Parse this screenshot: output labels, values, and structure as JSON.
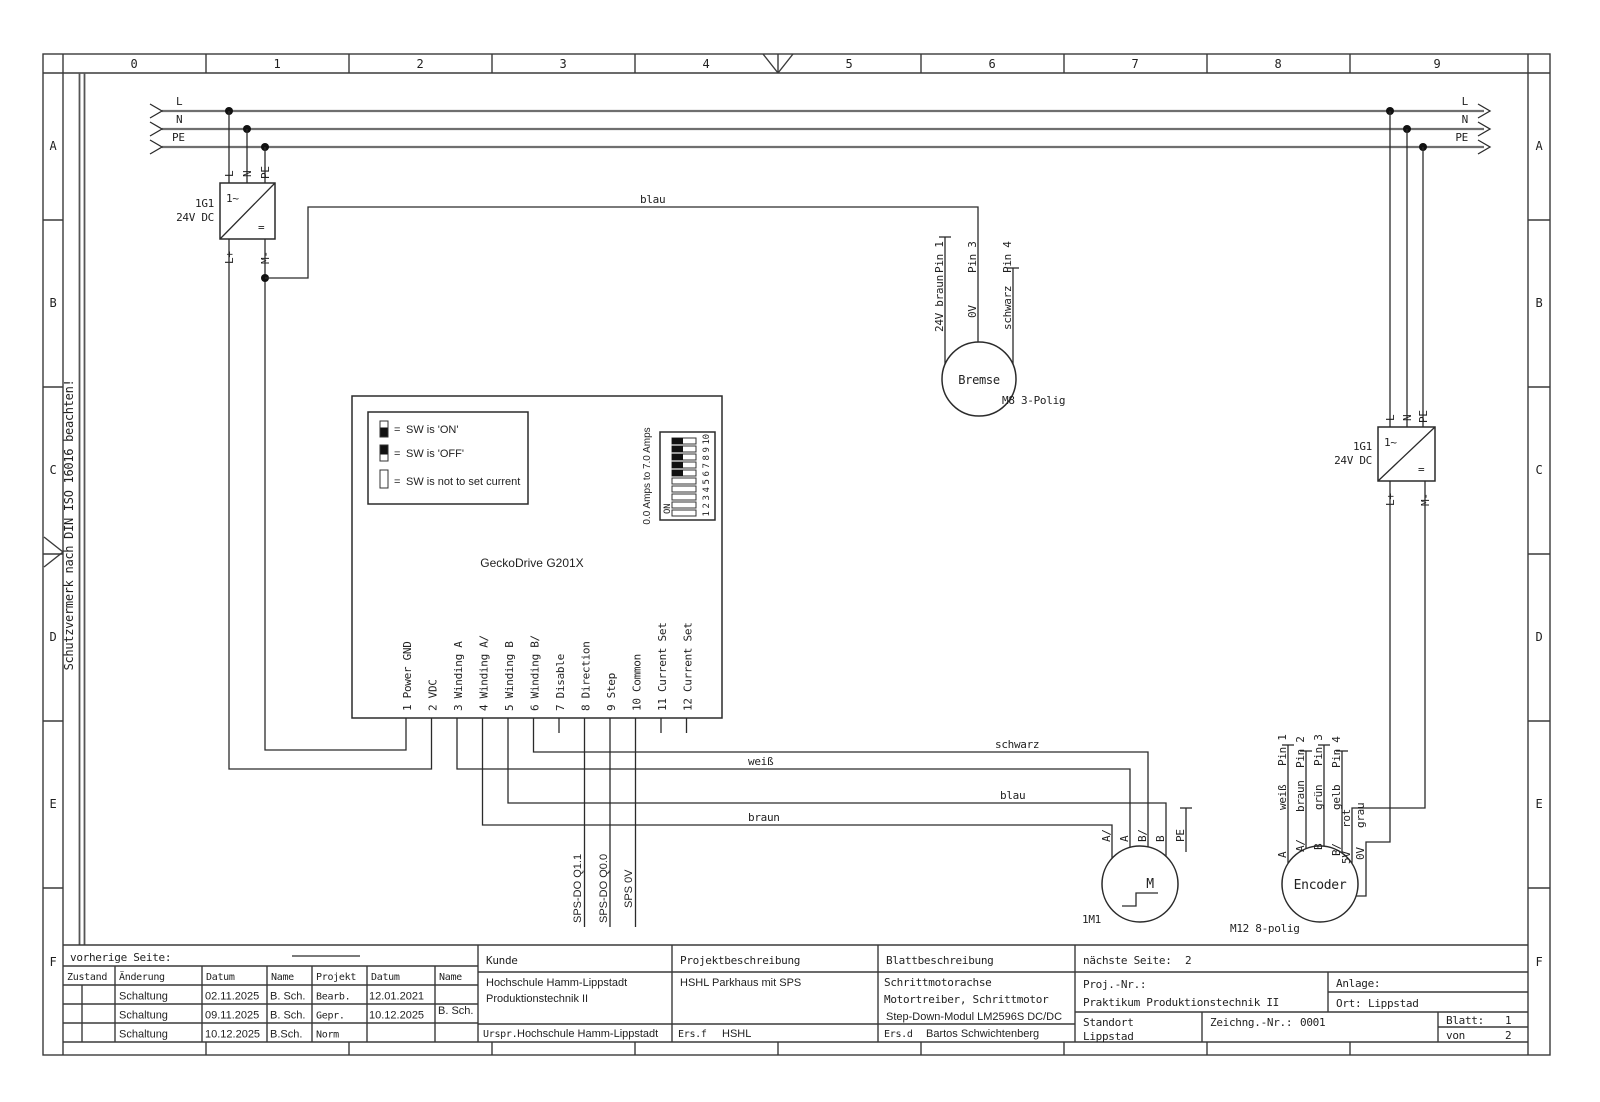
{
  "frame": {
    "cols": [
      "0",
      "1",
      "2",
      "3",
      "4",
      "5",
      "6",
      "7",
      "8",
      "9"
    ],
    "rows": [
      "A",
      "B",
      "C",
      "D",
      "E",
      "F"
    ],
    "note": "Schutzvermerk nach DIN ISO 16016 beachten!"
  },
  "rails": {
    "l": "L",
    "n": "N",
    "pe": "PE"
  },
  "psu": {
    "ref": "1G1",
    "volt": "24V DC",
    "ac": "1~",
    "dc": "=",
    "lp": "L+",
    "mm": "M-"
  },
  "blau_top": "blau",
  "bremse": {
    "name": "Bremse",
    "conn": "M8 3-Polig",
    "w1c": "24V braun",
    "w1p": "Pin 1",
    "w2c": "0V",
    "w2p": "Pin 3",
    "w3c": "schwarz",
    "w3p": "Pin 4"
  },
  "gecko": {
    "title": "GeckoDrive G201X",
    "eq": "=",
    "leg1": "SW is 'ON'",
    "leg2": "SW is 'OFF'",
    "leg3": "SW is not to set current",
    "amps": "0.0 Amps to 7.0 Amps",
    "on": "ON",
    "nums": [
      "1",
      "2",
      "3",
      "4",
      "5",
      "6",
      "7",
      "8",
      "9",
      "10"
    ],
    "pins": [
      "1 Power GND",
      "2 VDC",
      "3 Winding A",
      "4 Winding A/",
      "5 Winding B",
      "6 Winding B/",
      "7 Disable",
      "8 Direction",
      "9 Step",
      "10 Common",
      "11 Current Set",
      "12 Current Set"
    ]
  },
  "sps": {
    "q11": "SPS-DO Q1.1",
    "q00": "SPS-DO Q0.0",
    "v0": "SPS 0V"
  },
  "wires": {
    "schwarz": "schwarz",
    "weiss": "weiß",
    "blau": "blau",
    "braun": "braun"
  },
  "motor": {
    "ref": "1M1",
    "m": "M",
    "a_": "A/",
    "a": "A",
    "b_": "B/",
    "b": "B",
    "pe": "PE"
  },
  "encoder": {
    "name": "Encoder",
    "conn": "M12 8-polig",
    "fn": [
      "A",
      "A/",
      "B",
      "B/",
      "5V",
      "0V"
    ],
    "colors": [
      "weiß",
      "braun",
      "grün",
      "gelb",
      "rot",
      "grau"
    ],
    "pins": [
      "Pin 1",
      "Pin 2",
      "Pin 3",
      "Pin 4"
    ]
  },
  "tb": {
    "prev": "vorherige Seite:",
    "next": "nächste Seite:",
    "next_val": "2",
    "h": [
      "Zustand",
      "Änderung",
      "Datum",
      "Name",
      "Projekt",
      "Datum",
      "Name"
    ],
    "rows": [
      [
        "Schaltung",
        "02.11.2025",
        "B. Sch."
      ],
      [
        "Schaltung",
        "09.11.2025",
        "B. Sch."
      ],
      [
        "Schaltung",
        "10.12.2025",
        "B.Sch."
      ]
    ],
    "proj_rows": [
      "Bearb.",
      "Gepr.",
      "Norm"
    ],
    "d2": [
      "12.01.2021",
      "10.12.2025"
    ],
    "n2": "B. Sch.",
    "kunde_h": "Kunde",
    "kunde1": "Hochschule Hamm-Lippstadt",
    "kunde2": "Produktionstechnik II",
    "pb_h": "Projektbeschreibung",
    "pb": "HSHL Parkhaus mit SPS",
    "bb_h": "Blattbeschreibung",
    "bb1": "Schrittmotorachse",
    "bb2": "Motortreiber, Schrittmotor",
    "bb3": "Step-Down-Modul LM2596S DC/DC",
    "projnr": "Proj.-Nr.:",
    "projnr_val": "Praktikum  Produktionstechnik II",
    "anlage": "Anlage:",
    "ort": "Ort:",
    "ort_val": "Lippstad",
    "standort": "Standort",
    "standort_val": "Lippstad",
    "zeichnr": "Zeichng.-Nr.:",
    "zeichnr_val": "0001",
    "blatt": "Blatt:",
    "blatt_val": "1",
    "von": "von",
    "von_val": "2",
    "urspr": "Urspr.",
    "urspr_val": "Hochschule Hamm-Lippstadt",
    "ersf": "Ers.f",
    "ersf_val": "HSHL",
    "ersd": "Ers.d",
    "ersd_val": "Bartos Schwichtenberg"
  }
}
